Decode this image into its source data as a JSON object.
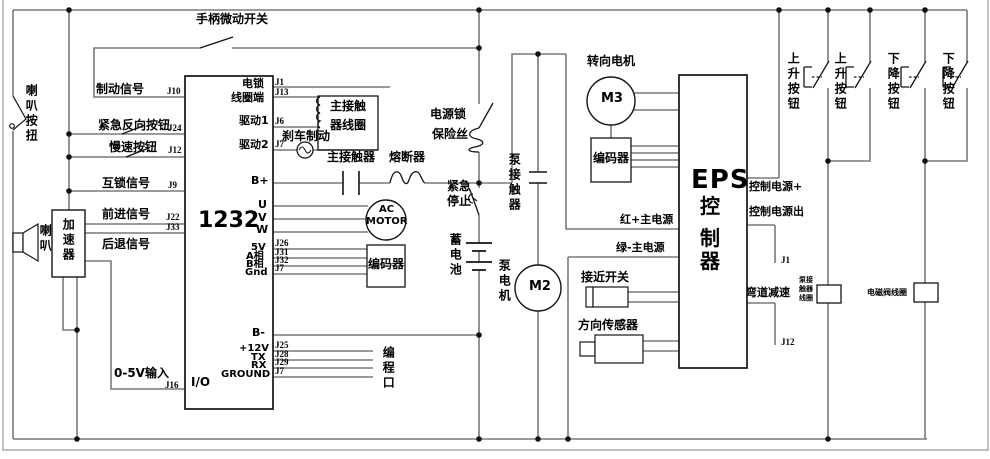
{
  "colors": {
    "wire": "#7a7a7a",
    "component": "#141414",
    "text": "#000000",
    "background": "#ffffff"
  },
  "left_section": {
    "handle_micro_switch": "手柄微动开关",
    "horn_button": "喇叭按扭",
    "horn": "喇叭",
    "accelerator": "加速器",
    "brake_signal": "制动信号",
    "emergency_reverse_button": "紧急反向按钮",
    "slow_button": "慢速按钮",
    "interlock_signal": "互锁信号",
    "forward_signal": "前进信号",
    "backward_signal": "后退信号",
    "analog_input": "0-5V输入",
    "pins": {
      "brake": "J10",
      "emergency_reverse": "J24",
      "slow": "J12",
      "interlock": "J9",
      "forward": "J22",
      "backward": "J33",
      "analog": "J16"
    }
  },
  "controller": {
    "model": "1232",
    "io": "I/O",
    "labels": {
      "lock_coil_line1": "电锁",
      "lock_coil_line2": "线圈端",
      "drive1": "驱动1",
      "drive2": "驱动2",
      "b_plus": "B+",
      "u": "U",
      "v": "V",
      "w": "W",
      "v5": "5V",
      "phase_a": "A相",
      "phase_b": "B相",
      "gnd": "Gnd",
      "b_minus": "B-",
      "p12v": "+12V",
      "tx": "TX",
      "rx": "RX",
      "ground": "GROUND"
    },
    "pins": {
      "j1": "J1",
      "j13": "J13",
      "j6": "J6",
      "j7": "J7",
      "j26": "J26",
      "j31": "J31",
      "j32": "J32",
      "j7_enc": "J7",
      "j25": "J25",
      "j28": "J28",
      "j29": "J29",
      "j7_io": "J7"
    }
  },
  "drive_circuit": {
    "main_contactor_coil_line1": "主接触",
    "main_contactor_coil_line2": "器线圈",
    "brake_coil": "刹车制动",
    "main_contactor": "主接触器",
    "fuse": "熔断器",
    "motor_line1": "AC",
    "motor_line2": "MOTOR",
    "encoder": "编码器",
    "programming_port": "编程口"
  },
  "power": {
    "key_lock": "电源锁",
    "key_fuse": "保险丝",
    "estop_line1": "紧急",
    "estop_line2": "停止",
    "battery": "蓄电池"
  },
  "pump": {
    "contactor": "泵接触器",
    "motor": "泵电机",
    "m2": "M2",
    "coil_line1": "泵接",
    "coil_line2": "触器",
    "coil_line3": "线圈"
  },
  "steering": {
    "label": "转向电机",
    "m3": "M3",
    "encoder": "编码器"
  },
  "eps": {
    "title": "EPS",
    "title_c1": "控",
    "title_c2": "制",
    "title_c3": "器",
    "red_main": "红+主电源",
    "green_main": "绿-主电源",
    "proximity_switch": "接近开关",
    "direction_sensor": "方向传感器",
    "control_power_in": "控制电源+",
    "control_power_out": "控制电源出",
    "curve_slowdown": "弯道减速",
    "pin_j1": "J1",
    "pin_j12": "J12"
  },
  "lift": {
    "up_button": "上升按钮",
    "down_button": "下降按钮",
    "solenoid_coil": "电磁阀线圈"
  }
}
